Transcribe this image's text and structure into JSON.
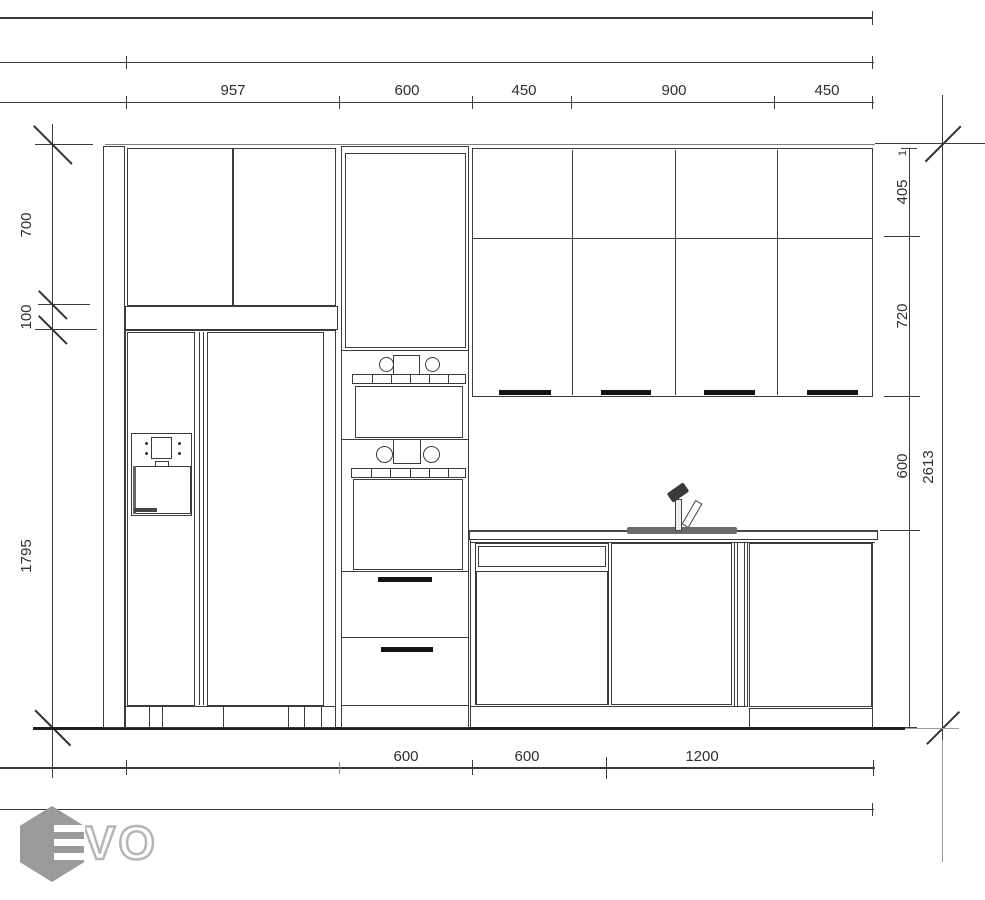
{
  "drawing_type": "kitchen-elevation-blueprint",
  "dimensions": {
    "top": [
      "957",
      "600",
      "450",
      "900",
      "450"
    ],
    "left": [
      "700",
      "100",
      "1795"
    ],
    "right": [
      "405",
      "720",
      "600"
    ],
    "total_height": "2613",
    "marker": "1",
    "bottom": [
      "600",
      "600",
      "1200"
    ]
  },
  "logo": {
    "text": "VO"
  },
  "colors": {
    "line": "#3b3b3b",
    "floor": "#1e1e1e",
    "handle": "#141414",
    "sink": "#6a6a6a",
    "logo_hex": "#9a9a9a",
    "logo_outline": "#b5b5b5",
    "background": "#ffffff"
  }
}
